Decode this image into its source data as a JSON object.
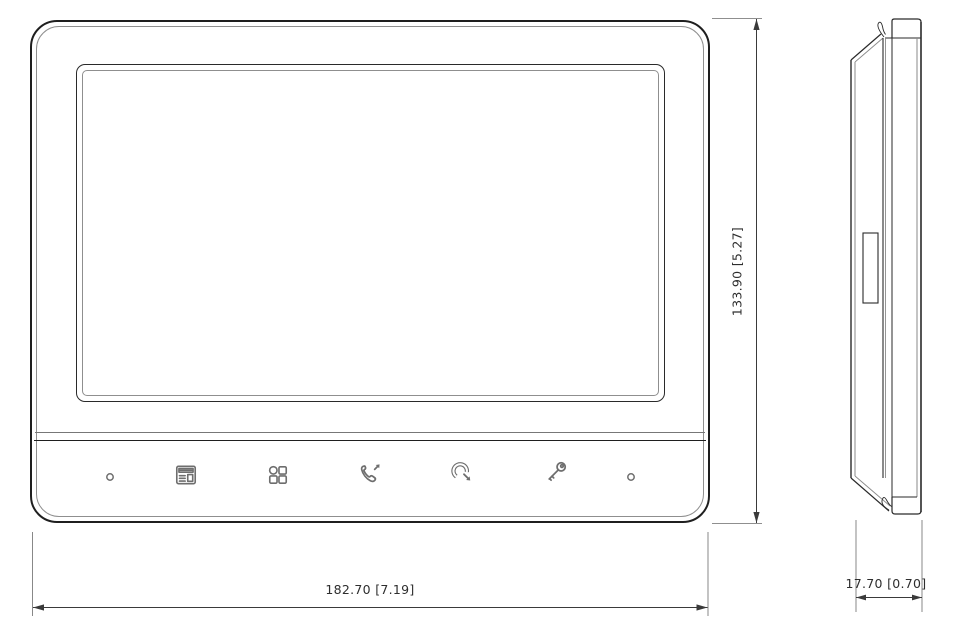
{
  "drawing": {
    "views": {
      "front": "front-elevation",
      "side": "side-profile"
    },
    "dimensions": {
      "width": {
        "label": "182.70 [7.19]"
      },
      "height": {
        "label": "133.90 [5.27]"
      },
      "depth": {
        "label": "17.70 [0.70]"
      }
    },
    "control_panel": {
      "buttons": [
        {
          "name": "led-indicator-left",
          "icon": "small-circle-led"
        },
        {
          "name": "monitor-button",
          "icon": "monitor-icon"
        },
        {
          "name": "menu-button",
          "icon": "menu-grid-icon"
        },
        {
          "name": "call-answer-button",
          "icon": "phone-answer-icon"
        },
        {
          "name": "call-end-button",
          "icon": "phone-hangup-icon"
        },
        {
          "name": "unlock-button",
          "icon": "key-unlock-icon"
        },
        {
          "name": "led-indicator-right",
          "icon": "small-circle-led"
        }
      ]
    },
    "colors": {
      "background": "#ffffff",
      "outline": "#1f1f1f",
      "secondary_line": "#8a8a8a",
      "icon": "#6e6e6e",
      "dimension_text": "#2e2e2e"
    }
  }
}
